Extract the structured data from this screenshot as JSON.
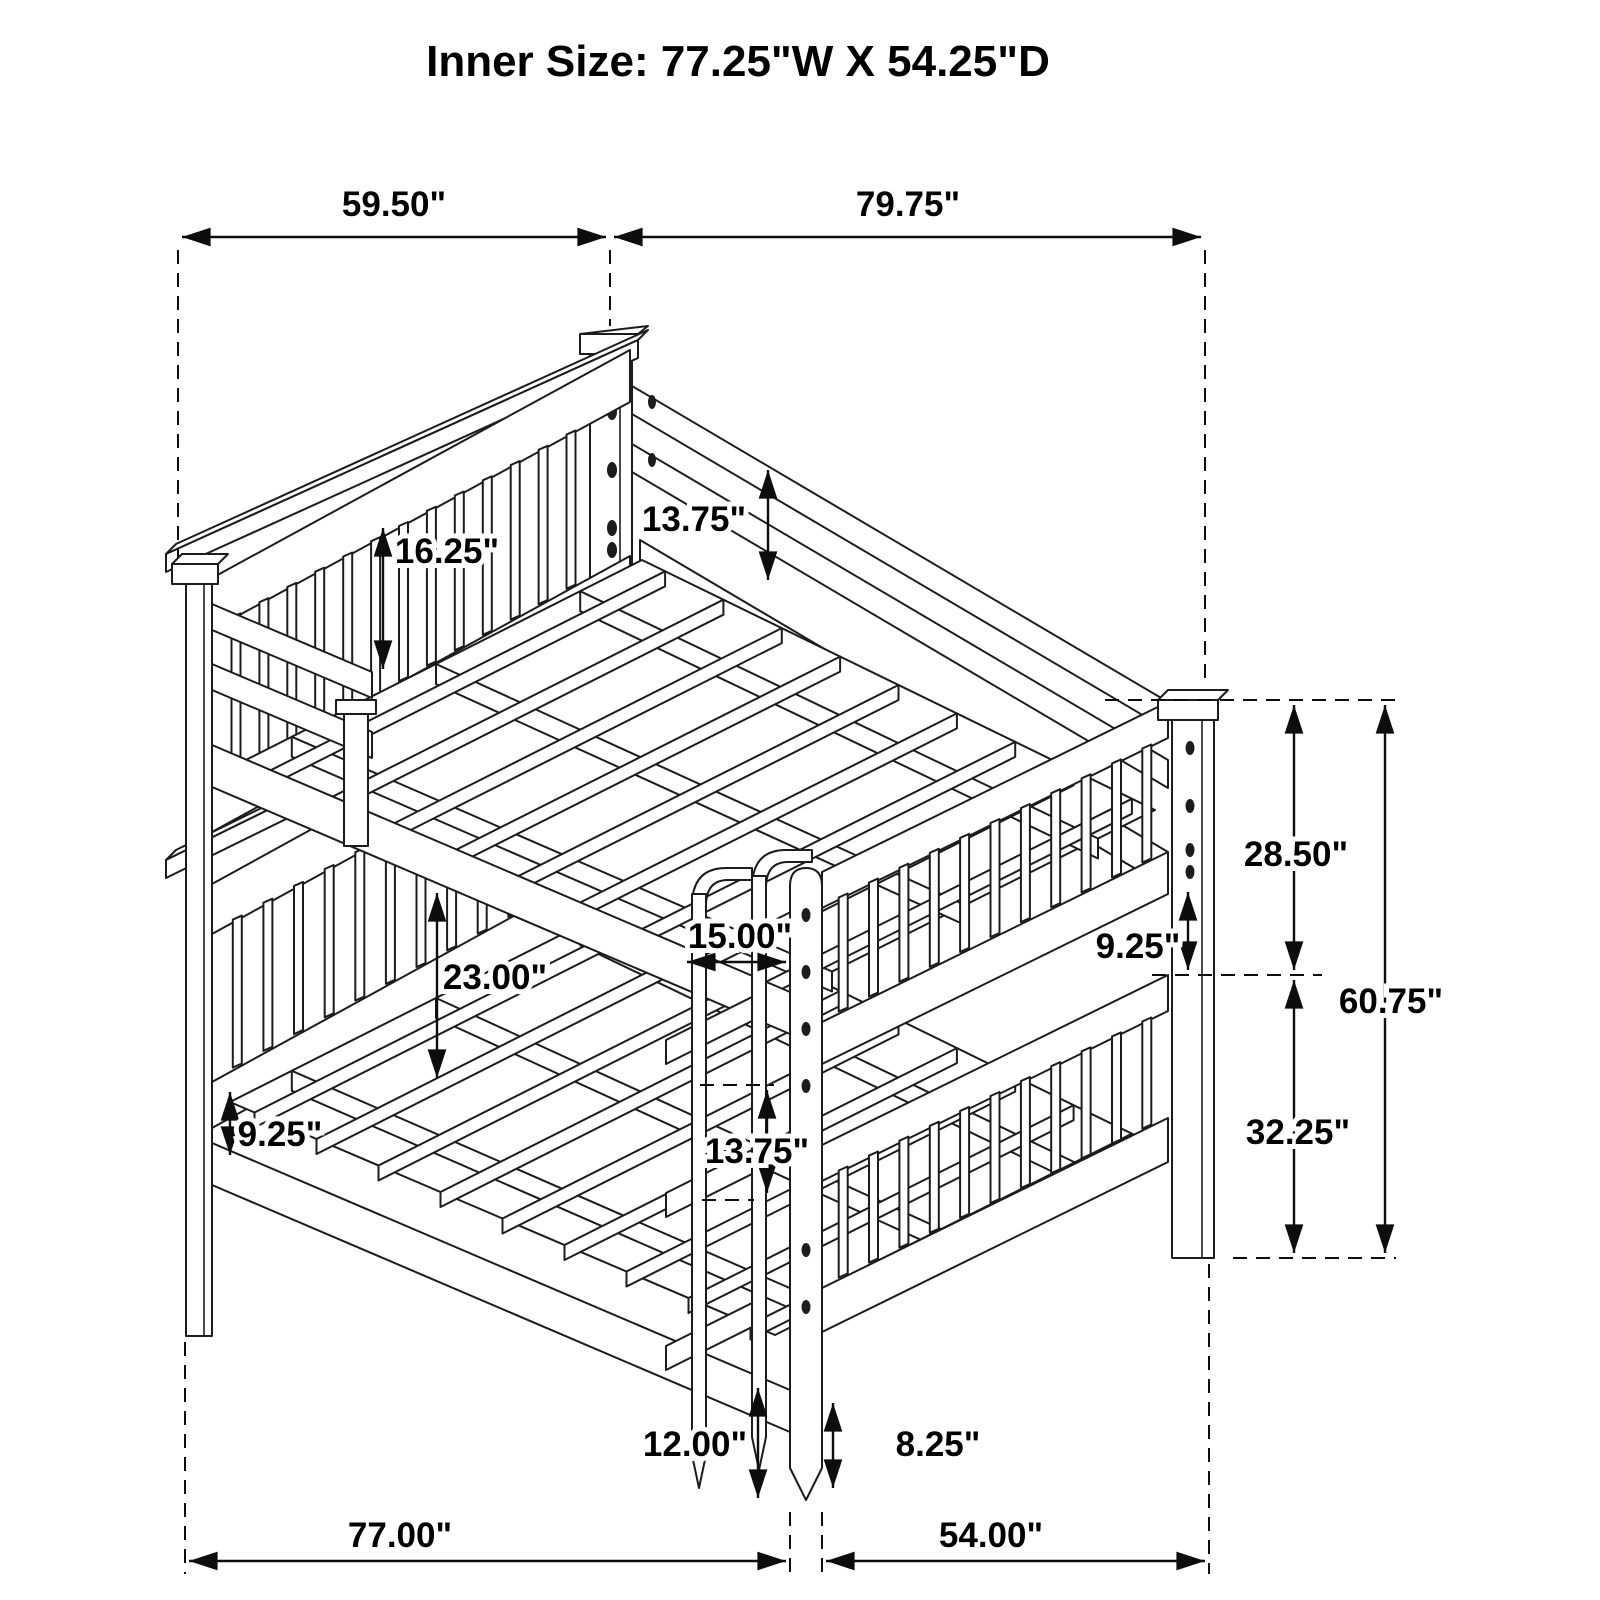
{
  "title": "Inner Size: 77.25\"W X 54.25\"D",
  "dimensions": {
    "top_width": "59.50\"",
    "top_length": "79.75\"",
    "headboard_guard_height": "16.25\"",
    "back_rail_height": "13.75\"",
    "bunk_clearance": "23.00\"",
    "ladder_width": "15.00\"",
    "ladder_rail_gap": "13.75\"",
    "side_rail_height": "9.25\"",
    "footboard_guard_height": "9.25\"",
    "upper_section_height": "28.50\"",
    "overall_height": "60.75\"",
    "lower_section_height": "32.25\"",
    "ladder_leg_height": "12.00\"",
    "leg_clearance_height": "8.25\"",
    "base_width": "77.00\"",
    "base_depth": "54.00\""
  }
}
